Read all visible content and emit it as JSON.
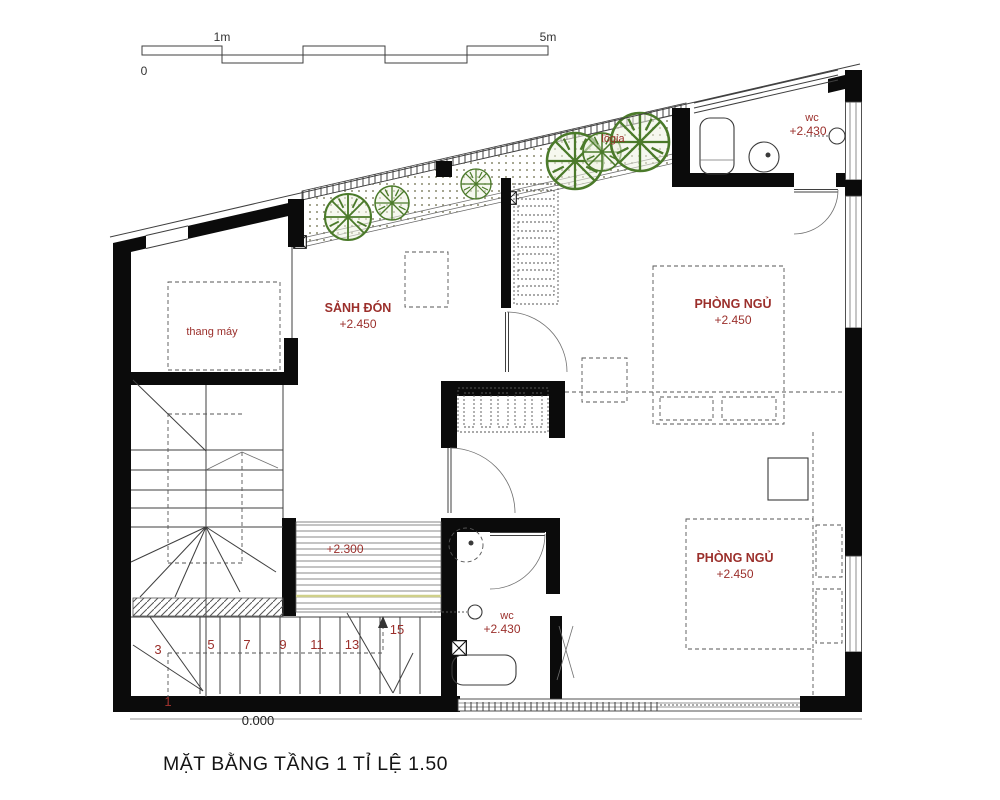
{
  "title": "MẶT BẰNG TẦNG 1  TỈ LỆ 1.50",
  "scale_bar": {
    "start": "0",
    "one_meter": "1m",
    "five_meter": "5m"
  },
  "rooms": {
    "hall": {
      "name": "SẢNH ĐÓN",
      "level": "+2.450"
    },
    "bedroom1": {
      "name": "PHÒNG NGỦ",
      "level": "+2.450"
    },
    "bedroom2": {
      "name": "PHÒNG NGỦ",
      "level": "+2.450"
    },
    "wc_top": {
      "name": "wc",
      "level": "+2.430"
    },
    "wc_mid": {
      "name": "wc",
      "level": "+2.430"
    },
    "elevator": {
      "name": "thang máy"
    },
    "loggia": {
      "name": "lôgia"
    },
    "deck": {
      "level": "+2.300"
    }
  },
  "levels": {
    "ground": "0.000"
  },
  "stairs": {
    "numbers": [
      "1",
      "3",
      "5",
      "7",
      "9",
      "11",
      "13",
      "15"
    ]
  },
  "colors": {
    "label_red": "#9b2f2b",
    "plant_green": "#4b7a2a",
    "wall_black": "#0b0b0b",
    "deck_accent": "#cfd08a"
  }
}
